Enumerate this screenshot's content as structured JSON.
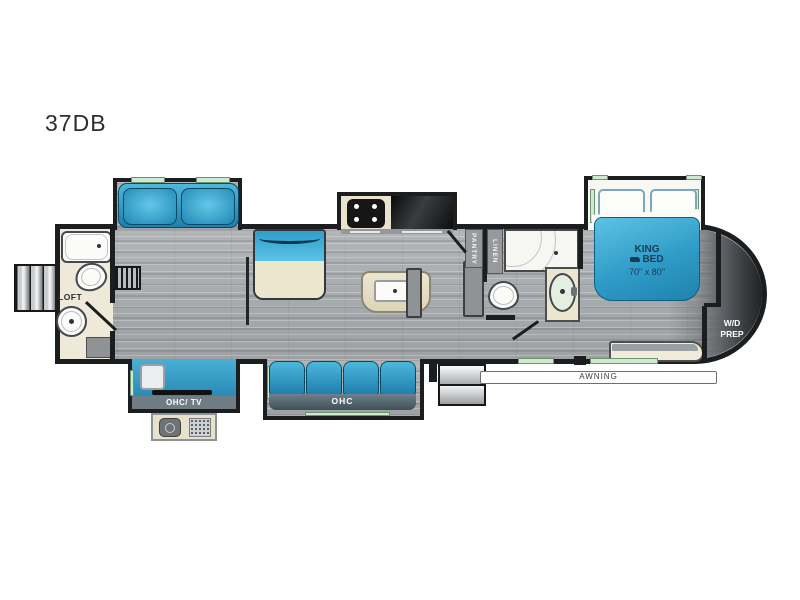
{
  "title": "37DB",
  "labels": {
    "loft": "LOFT",
    "pantry": "PANTRY",
    "linen": "LINEN",
    "king": "KING",
    "bed": "BED",
    "bed_size": "70\" x 80\"",
    "wd": "W/D",
    "prep": "PREP",
    "ohc_tv": "OHC/ TV",
    "ohc": "OHC",
    "awning": "AWNING"
  },
  "colors": {
    "furniture_blue": "#2f9cc7",
    "floor_gray": "#a9adb0",
    "bath_beige": "#efe9da",
    "wall_black": "#1c1d1f",
    "window_green": "#cde9cf"
  }
}
